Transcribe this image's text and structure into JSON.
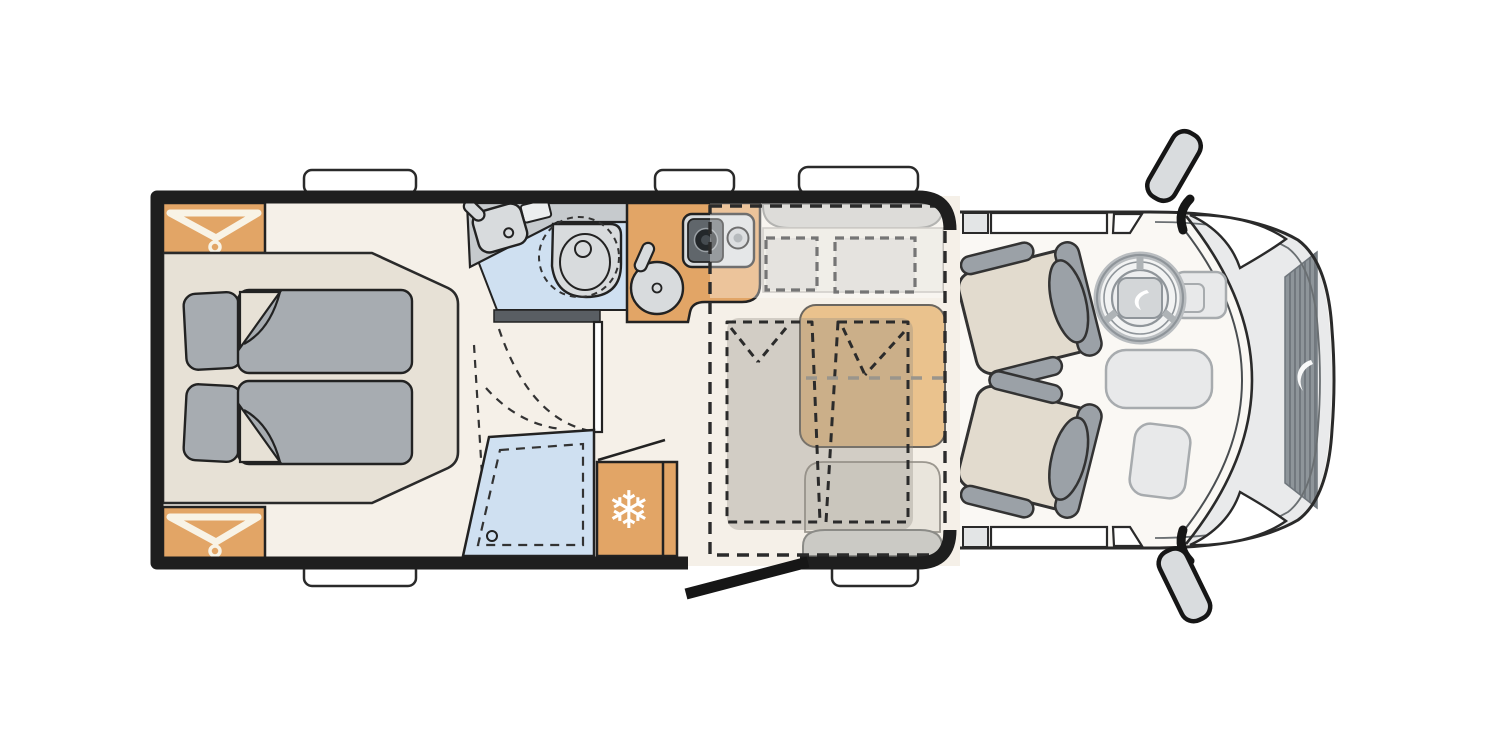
{
  "diagram": {
    "type": "motorhome-floorplan-top-view",
    "orientation": "cab-on-right",
    "regions": [
      "rear-bedroom",
      "wardrobe-top",
      "wardrobe-bottom",
      "double-bed",
      "bathroom",
      "washbasin",
      "swivel-toilet",
      "shower",
      "refrigerator",
      "kitchen",
      "two-burner-hob",
      "kitchen-sink",
      "dinette",
      "dining-table",
      "drop-down-bed",
      "entry-door",
      "habitation-walls",
      "cab",
      "driver-seat",
      "passenger-seat",
      "steering-wheel",
      "dashboard",
      "engine-grille",
      "side-mirror-top",
      "side-mirror-bottom",
      "windows",
      "entry-step"
    ]
  },
  "icons": {
    "snowflake": "❄"
  },
  "palette": {
    "white": "#ffffff",
    "ink": "#222222",
    "black": "#161616",
    "wall": "#1e1e1e",
    "floor": "#f5f0e8",
    "cabfloor": "#faf8f4",
    "wood": "#e2a566",
    "woodlight": "#eac28d",
    "bedbase": "#e7e1d6",
    "bedding": "#a7acb1",
    "bathblue": "#cfe0f1",
    "fixture": "#d8dbdd",
    "counter": "#c6cacd",
    "partition": "#595e63",
    "benchback": "#cbcac5",
    "benchseat": "#e9e5dc",
    "cushion": "#c9c7c2",
    "seatbeige": "#e2dbce",
    "seatgray": "#9ba1a7",
    "hood": "#e9eaeb",
    "console": "#e8e9ea",
    "consoleline": "#a7abae",
    "grille": "#8e959a",
    "grilleline": "#6f767c",
    "overlay": "#8f8a80",
    "softdash": "#9a958c",
    "hanger": "#f8f3e6",
    "mirror": "#d9dcde",
    "stovetop": "#d7dadc",
    "stovemod": "#60666b",
    "burnerdark": "#23272a",
    "glassgray": "#e3e5e6"
  }
}
